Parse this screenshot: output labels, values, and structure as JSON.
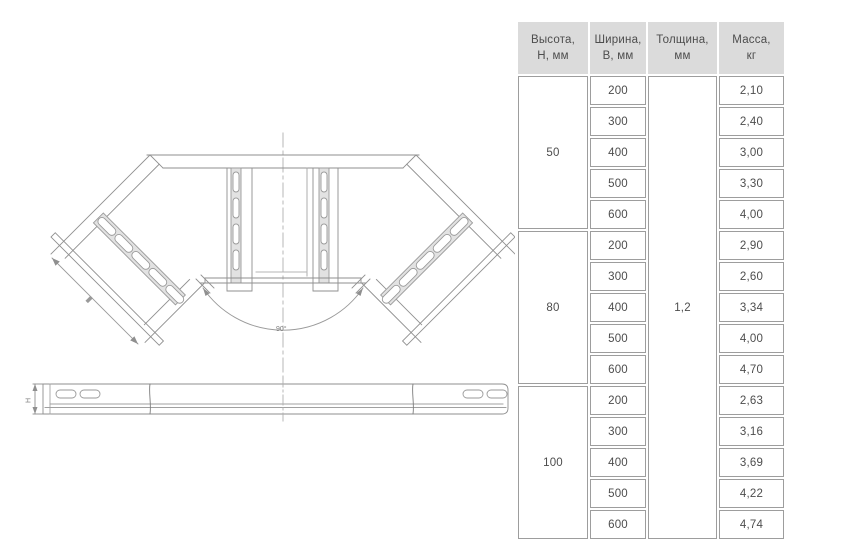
{
  "table": {
    "headers": [
      {
        "line1": "Высота,",
        "line2": "Н, мм"
      },
      {
        "line1": "Ширина,",
        "line2": "В, мм"
      },
      {
        "line1": "Толщина,",
        "line2": "мм"
      },
      {
        "line1": "Масса,",
        "line2": "кг"
      }
    ],
    "thickness": "1,2",
    "groups": [
      {
        "height": "50",
        "rows": [
          {
            "width": "200",
            "mass": "2,10"
          },
          {
            "width": "300",
            "mass": "2,40"
          },
          {
            "width": "400",
            "mass": "3,00"
          },
          {
            "width": "500",
            "mass": "3,30"
          },
          {
            "width": "600",
            "mass": "4,00"
          }
        ]
      },
      {
        "height": "80",
        "rows": [
          {
            "width": "200",
            "mass": "2,90"
          },
          {
            "width": "300",
            "mass": "2,60"
          },
          {
            "width": "400",
            "mass": "3,34"
          },
          {
            "width": "500",
            "mass": "4,00"
          },
          {
            "width": "600",
            "mass": "4,70"
          }
        ]
      },
      {
        "height": "100",
        "rows": [
          {
            "width": "200",
            "mass": "2,63"
          },
          {
            "width": "300",
            "mass": "3,16"
          },
          {
            "width": "400",
            "mass": "3,69"
          },
          {
            "width": "500",
            "mass": "4,22"
          },
          {
            "width": "600",
            "mass": "4,74"
          }
        ]
      }
    ]
  },
  "drawing": {
    "angle_label": "90°",
    "height_dim_label": "H"
  },
  "colors": {
    "header_bg": "#dbdbdb",
    "cell_border": "#9d9d9d",
    "text": "#4d4d4d",
    "drawing_line": "#8f8f8f",
    "rung_fill": "#e2e2e2"
  }
}
